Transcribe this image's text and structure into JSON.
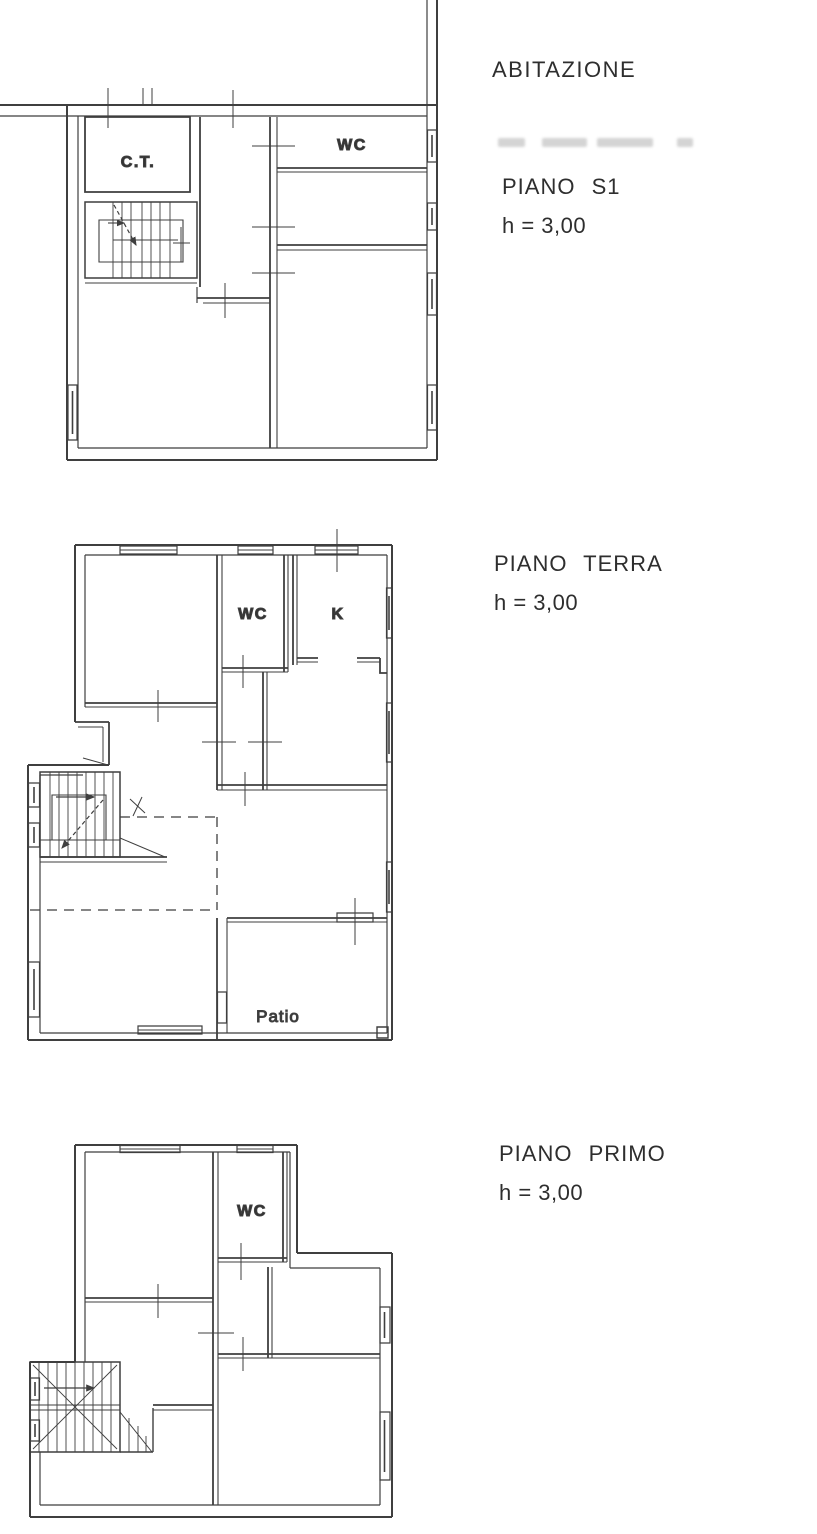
{
  "header": {
    "building_label": "ABITAZIONE"
  },
  "colors": {
    "ink": "#3f3f3f",
    "text": "#2e2e2e",
    "smudge": "#c6c6c6"
  },
  "floors": [
    {
      "id": "s1",
      "name": "PIANO S1",
      "height": "h = 3,00",
      "rooms": [
        {
          "label": "C.T."
        },
        {
          "label": "WC"
        }
      ]
    },
    {
      "id": "terra",
      "name": "PIANO TERRA",
      "height": "h = 3,00",
      "rooms": [
        {
          "label": "WC"
        },
        {
          "label": "K"
        },
        {
          "label": "Patio"
        }
      ]
    },
    {
      "id": "primo",
      "name": "PIANO PRIMO",
      "height": "h = 3,00",
      "rooms": [
        {
          "label": "WC"
        }
      ]
    }
  ]
}
